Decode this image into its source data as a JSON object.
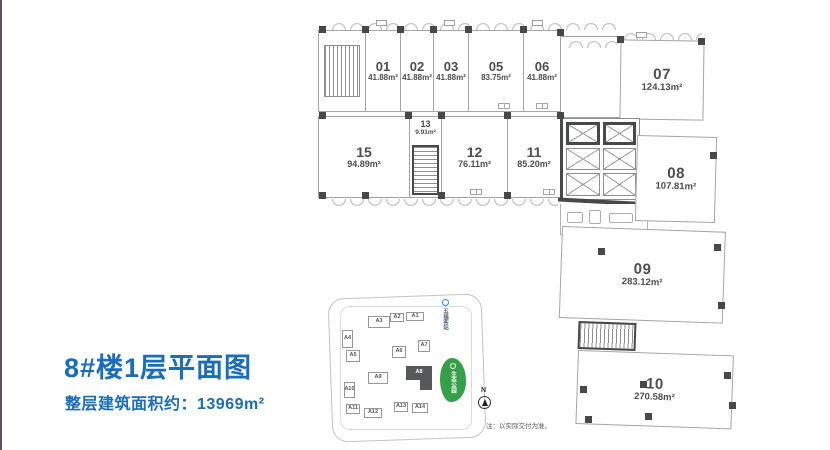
{
  "page": {
    "title": "8#楼1层平面图",
    "subtitle": "整层建筑面积约：13969m²",
    "note": "注：以实际交付为准。",
    "accent_color": "#1a6db8"
  },
  "units": {
    "u01": {
      "num": "01",
      "area": "41.88m²"
    },
    "u02": {
      "num": "02",
      "area": "41.88m²"
    },
    "u03": {
      "num": "03",
      "area": "41.88m²"
    },
    "u05": {
      "num": "05",
      "area": "83.75m²"
    },
    "u06": {
      "num": "06",
      "area": "41.88m²"
    },
    "u07": {
      "num": "07",
      "area": "124.13m²"
    },
    "u08": {
      "num": "08",
      "area": "107.81m²"
    },
    "u09": {
      "num": "09",
      "area": "283.12m²"
    },
    "u10": {
      "num": "10",
      "area": "270.58m²"
    },
    "u11": {
      "num": "11",
      "area": "85.20m²"
    },
    "u12": {
      "num": "12",
      "area": "76.11m²"
    },
    "u13": {
      "num": "13",
      "area": "9.91m²"
    },
    "u15": {
      "num": "15",
      "area": "94.89m²"
    }
  },
  "sitemap": {
    "buildings": {
      "a1": "A1",
      "a2": "A2",
      "a3": "A3",
      "a4": "A4",
      "a5": "A5",
      "a6": "A6",
      "a7": "A7",
      "a8": "A8",
      "a9": "A9",
      "a10": "A10",
      "a11": "A11",
      "a12": "A12",
      "a13": "A13",
      "a14": "A14"
    },
    "highlighted_building": "A8",
    "park_label": "生态公园",
    "station_label": "五福客站",
    "compass_label": "N",
    "park_color": "#35a047",
    "station_color": "#2f8fd0"
  }
}
